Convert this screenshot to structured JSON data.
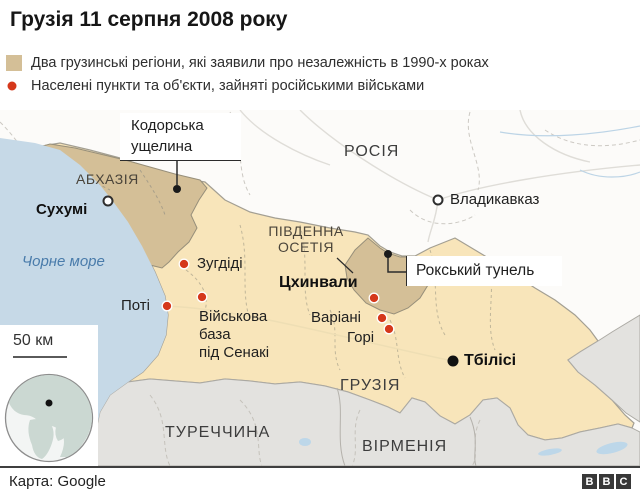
{
  "title": "Грузія 11 серпня 2008 року",
  "legend": {
    "items": [
      {
        "label": "Два грузинські регіони, які заявили про незалежність в 1990-х роках"
      },
      {
        "label": "Населені пункти та об'єкти, зайняті російськими військами"
      }
    ]
  },
  "map": {
    "colors": {
      "sea": "#c6d9e7",
      "georgia": "#f8e5ba",
      "claimed_region": "#d4bf97",
      "neighbor_gray": "#e3e2df",
      "russia_background": "#fcfbf9",
      "occupied_dot": "#d5381b",
      "black_marker": "#1a1a1a",
      "globe_land": "#cbd8d2",
      "globe_ocean": "#f3f5f4"
    },
    "countries": {
      "russia": "РОСІЯ",
      "georgia": "ГРУЗІЯ",
      "turkey": "ТУРЕЧЧИНА",
      "armenia": "ВІРМЕНІЯ"
    },
    "regions": {
      "abkhazia": "АБХАЗІЯ",
      "south_ossetia": "ПІВДЕННА\nОСЕТІЯ"
    },
    "sea_label": "Чорне море",
    "cities": {
      "sukhumi": "Сухумі",
      "vladikavkaz": "Владикавказ",
      "zugdidi": "Зугдіді",
      "poti": "Поті",
      "tskhinvali": "Цхинвали",
      "variani": "Варіані",
      "gori": "Горі",
      "tbilisi": "Тбілісі",
      "senaki_base": "Військова\nбаза\nпід Сенакі"
    },
    "callouts": {
      "kodori_gorge": "Кодорська\nущелина",
      "roki_tunnel": "Рокський тунель"
    },
    "scale_label": "50 км"
  },
  "footer": {
    "attribution": "Карта: Google",
    "logo_letters": [
      "B",
      "B",
      "C"
    ]
  }
}
